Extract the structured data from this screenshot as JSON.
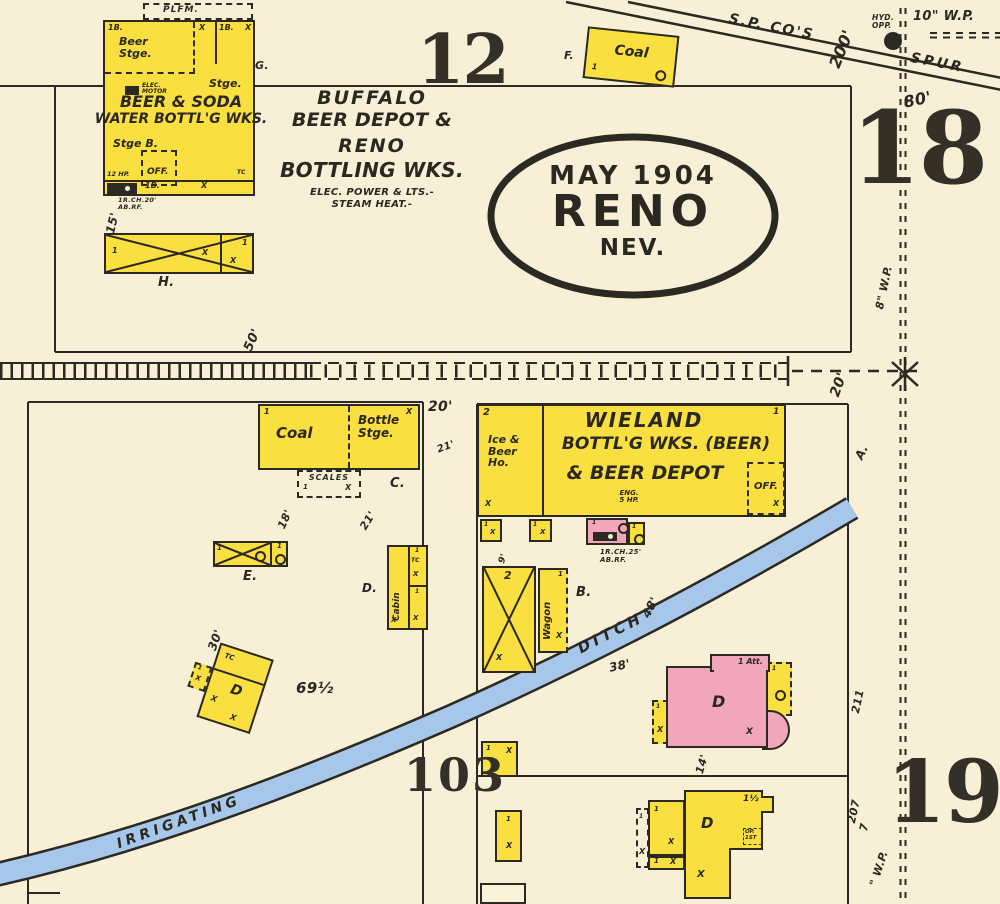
{
  "title": {
    "month_year": "MAY 1904",
    "city": "RENO",
    "state": "NEV."
  },
  "blocks": {
    "b12": "12",
    "b18": "18",
    "b19": "19",
    "street_103": "103"
  },
  "railroad": {
    "sp": "S.P. CO'S",
    "spur": "SPUR"
  },
  "water": {
    "hyd": "HYD.\nOPP.",
    "wp10": "10\" W.P.",
    "wp8": "8\" W.P.",
    "wp": "\" W.P."
  },
  "ditch": {
    "irrigating": "IRRIGATING",
    "ditch": "DITCH"
  },
  "dims": {
    "d200": "200'",
    "d80": "80'",
    "d20a": "20'",
    "d20b": "20'",
    "d21a": "21'",
    "d21b": "21'",
    "d18": "18'",
    "d15": "15'",
    "d50": "50'",
    "d30": "30'",
    "d48": "48'",
    "d38": "38'",
    "d14": "14'",
    "d69": "69½",
    "d211": "211",
    "d207": "207",
    "d7": "7",
    "d9": "9'"
  },
  "marks": {
    "x": "X",
    "one": "1",
    "two": "2",
    "tc": "TC",
    "b1": "1B."
  },
  "refs": {
    "a": "A.",
    "b": "B.",
    "c": "C.",
    "d": "D.",
    "e": "E.",
    "f": "F.",
    "g": "G.",
    "h": "H."
  },
  "nw": {
    "plfm": "PLFM.",
    "beer_room": "Beer\nStge.",
    "name1": "BEER & SODA",
    "name2": "WATER BOTTL'G WKS.",
    "stge": "Stge.",
    "stge_b": "Stge B.",
    "off": "OFF.",
    "elec": "ELEC.\nMOTOR",
    "hp": "12 HP.",
    "note": "1R.CH.20'\nAB.RF."
  },
  "depot": {
    "l1": "BUFFALO",
    "l2": "BEER DEPOT &",
    "l3": "RENO",
    "l4": "BOTTLING WKS.",
    "l5": "ELEC. POWER & LTS.-",
    "l6": "STEAM HEAT.-"
  },
  "coalshed": {
    "label": "Coal"
  },
  "wieland": {
    "ice": "Ice &\nBeer\nHo.",
    "l1": "WIELAND",
    "l2": "BOTTL'G WKS. (BEER)",
    "l3": "& BEER DEPOT",
    "eng": "ENG.\n5 HP.",
    "off": "OFF.",
    "note": "1R.CH.25'\nAB.RF."
  },
  "coalyard": {
    "coal": "Coal",
    "bottle": "Bottle\nStge.",
    "scales": "SCALES"
  },
  "sheds": {
    "wagon": "Wagon",
    "cabin": "Cabin"
  },
  "dwell": {
    "d": "D",
    "att": "1 Att.",
    "half": "1½",
    "op": "OP.\n1ST"
  }
}
